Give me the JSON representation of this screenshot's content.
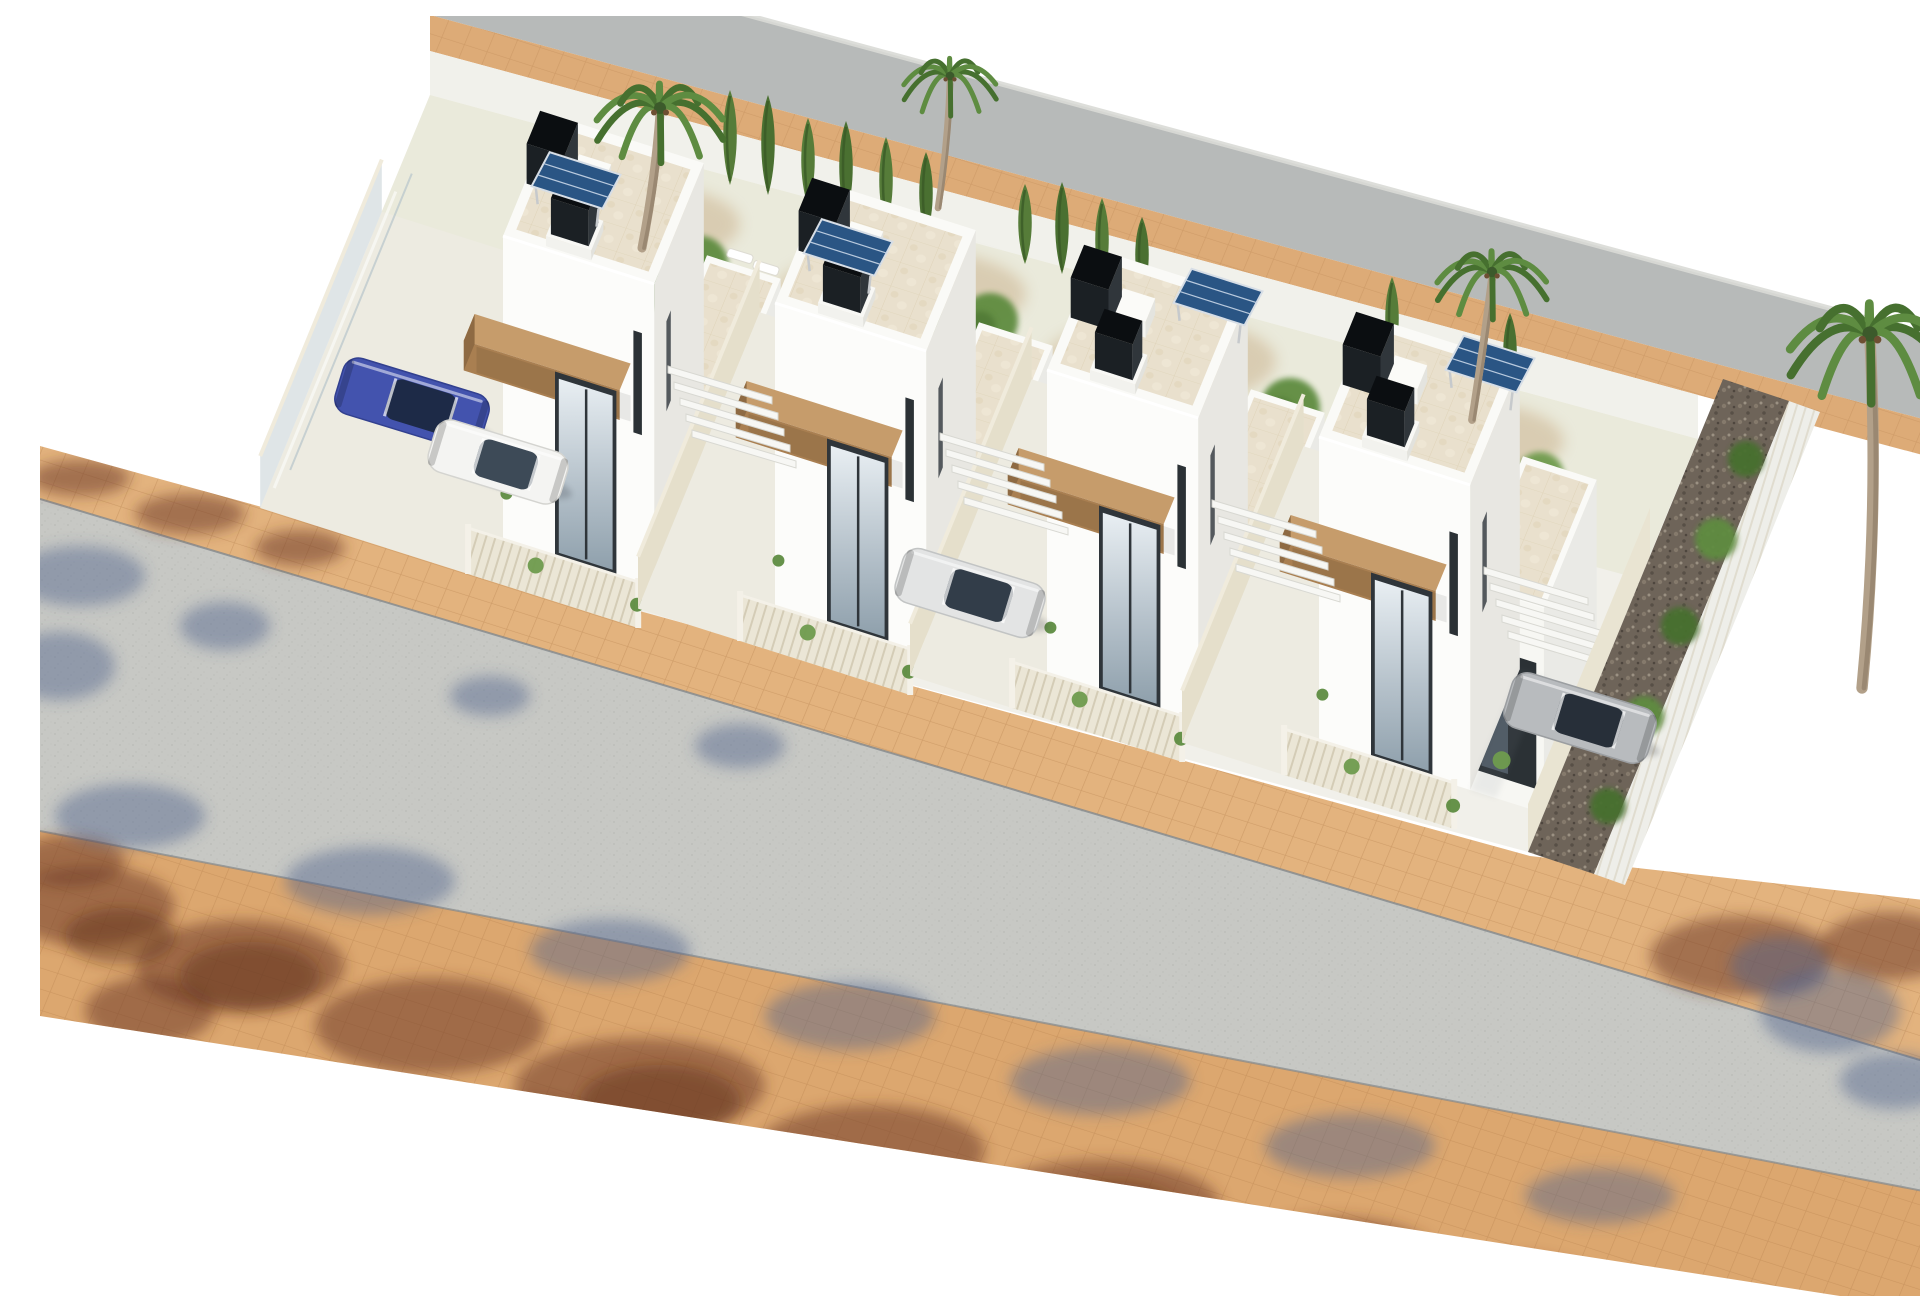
{
  "colors": {
    "bg": "#ffffff",
    "ground": "#f1f0ea",
    "patio": "#edebe1",
    "garden": "#eaeadb",
    "road_front": "#c7c8c4",
    "walk_tan": "#e3b37e",
    "walk_tan2": "#dca76f",
    "curb": "#82878b",
    "road_back": "#b7bab9",
    "back_tan": "#ddab77",
    "back_wall": "#f1f1eb",
    "far_fence": "#d9dad6",
    "tower_front": "#fcfcfa",
    "tower_side": "#e8e7e2",
    "low_front": "#f7f7f3",
    "low_side": "#eaeae6",
    "parapet": "#fafaf7",
    "deck_base": "#e9e0cd",
    "deck_line": "#dccfb4",
    "wood_top": "#c69c6b",
    "wood_front": "#a97f51",
    "wood_side": "#8e6a43",
    "fence_base": "#ebe6d6",
    "fence_slat": "#cdc5ad",
    "fence_top": "#f4f1e8",
    "beige_wall": "#e5dfcb",
    "beige_top": "#f0ebdc",
    "glass_wall": "#dfe5e7",
    "door_frame": "#2f353a",
    "win_dark": "#2b3135",
    "solar": "#2a5584",
    "solar_line": "#b9cade",
    "solar_frame": "#d7dee6",
    "solar_leg": "#c6c9cc",
    "box_front": "#1b2024",
    "box_side": "#30363b",
    "box_top": "#0b0e11",
    "ac_white": "#f4f4f0",
    "green_dark": "#46702f",
    "green_mid": "#5e8c41",
    "green_light": "#6f9b4e",
    "gravel_base": "#6e6459",
    "shadow_brown": "#6f3c27",
    "shadow_brown2": "#5a2d1c",
    "shadow_blue": "#4f618c",
    "trunk": "#b2a089",
    "trunk2": "#9a8872",
    "pool_rim": "#ffffff"
  },
  "projection": {
    "u": [
      0.945,
      0.3
    ],
    "v": [
      0.32,
      -0.78
    ]
  },
  "street": {
    "walk_top": [
      [
        0,
        430
      ],
      [
        1490,
        840
      ],
      [
        1920,
        888
      ]
    ],
    "road_top": [
      [
        0,
        483
      ],
      [
        1920,
        1056
      ]
    ],
    "road_bottom": [
      [
        0,
        815
      ],
      [
        1920,
        1182
      ]
    ],
    "walk_bottom": [
      [
        0,
        1000
      ],
      [
        1800,
        1280
      ]
    ]
  },
  "back_road": {
    "wall_band": [
      [
        390,
        79
      ],
      [
        1658,
        423
      ],
      [
        1658,
        379
      ],
      [
        390,
        35
      ]
    ],
    "tan": [
      [
        390,
        35
      ],
      [
        1658,
        379
      ],
      [
        1920,
        449
      ],
      [
        1920,
        413
      ],
      [
        1658,
        343
      ],
      [
        390,
        -1
      ]
    ],
    "road": [
      [
        390,
        -1
      ],
      [
        1658,
        343
      ],
      [
        1920,
        413
      ],
      [
        1920,
        327
      ],
      [
        1658,
        257
      ],
      [
        390,
        -87
      ]
    ],
    "far_fence": [
      [
        390,
        -87
      ],
      [
        1658,
        257
      ],
      [
        1920,
        327
      ]
    ]
  },
  "ground": [
    [
      220,
      492
    ],
    [
      1488,
      836
    ],
    [
      1658,
      423
    ],
    [
      390,
      79
    ]
  ],
  "garden": [
    [
      332,
      219
    ],
    [
      1600,
      563
    ],
    [
      1658,
      423
    ],
    [
      390,
      79
    ]
  ],
  "pebbles": [
    [
      600,
      208,
      100,
      40
    ],
    [
      860,
      278,
      126,
      46
    ],
    [
      1120,
      345,
      116,
      44
    ],
    [
      1420,
      425,
      104,
      40
    ]
  ],
  "bushes": [
    [
      540,
      196,
      24
    ],
    [
      660,
      248,
      28
    ],
    [
      800,
      246,
      22
    ],
    [
      950,
      305,
      28
    ],
    [
      1060,
      330,
      24
    ],
    [
      1250,
      392,
      30
    ],
    [
      1500,
      460,
      24
    ],
    [
      620,
      276,
      18
    ],
    [
      880,
      300,
      20
    ]
  ],
  "cypresses": [
    [
      690,
      169,
      95
    ],
    [
      728,
      179,
      100
    ],
    [
      768,
      190,
      88
    ],
    [
      806,
      200,
      95
    ],
    [
      846,
      211,
      90
    ],
    [
      886,
      221,
      85
    ],
    [
      985,
      248,
      80
    ],
    [
      1022,
      258,
      92
    ],
    [
      1062,
      268,
      86
    ],
    [
      1102,
      279,
      78
    ],
    [
      1352,
      346,
      85
    ],
    [
      1470,
      377,
      80
    ]
  ],
  "loungers": [
    [
      700,
      240
    ],
    [
      726,
      252
    ]
  ],
  "pool": [
    [
      1300,
      390
    ],
    [
      1338,
      401
    ],
    [
      1298,
      495
    ],
    [
      1260,
      484
    ]
  ],
  "villas": [
    {
      "origin": [
        463,
        525
      ],
      "solar": "L",
      "left_u": -240,
      "wall": "glass"
    },
    {
      "origin": [
        735,
        592
      ],
      "solar": "L",
      "left_u": -128,
      "wall": "beige"
    },
    {
      "origin": [
        1007,
        659
      ],
      "solar": "R",
      "left_u": -128,
      "wall": "beige"
    },
    {
      "origin": [
        1279,
        726
      ],
      "solar": "R",
      "left_u": -128,
      "wall": "beige"
    }
  ],
  "louvers": [
    [
      628,
      350
    ],
    [
      900,
      417
    ],
    [
      1172,
      484
    ],
    [
      1444,
      551
    ]
  ],
  "right_wall": [
    [
      1488,
      836
    ],
    [
      1610,
      540
    ],
    [
      1610,
      492
    ],
    [
      1488,
      788
    ]
  ],
  "gravel": [
    [
      1488,
      836
    ],
    [
      1610,
      540
    ],
    [
      1683,
      363
    ],
    [
      1749,
      385
    ],
    [
      1676,
      565
    ],
    [
      1554,
      858
    ]
  ],
  "right_fence": [
    [
      1554,
      858
    ],
    [
      1676,
      565
    ],
    [
      1749,
      385
    ],
    [
      1780,
      396
    ],
    [
      1707,
      576
    ],
    [
      1585,
      869
    ]
  ],
  "gravel_bushes": [
    [
      1568,
      790,
      18
    ],
    [
      1604,
      700,
      20
    ],
    [
      1640,
      610,
      19
    ],
    [
      1676,
      523,
      21
    ],
    [
      1706,
      443,
      18
    ]
  ],
  "cars": [
    {
      "c": [
        372,
        388
      ],
      "angle": 17,
      "len": 152,
      "w": 58,
      "color": "blue",
      "name": "blue-car"
    },
    {
      "c": [
        458,
        446
      ],
      "angle": 17,
      "len": 138,
      "w": 54,
      "color": "white",
      "name": "white-car"
    },
    {
      "c": [
        930,
        577
      ],
      "angle": 17,
      "len": 148,
      "w": 56,
      "color": "silver",
      "name": "silver-car"
    },
    {
      "c": [
        1540,
        702
      ],
      "angle": 17,
      "len": 150,
      "w": 57,
      "color": "gray",
      "name": "gray-car"
    }
  ],
  "car_colors": {
    "blue": {
      "body": "#4353ae",
      "glass": "#1d2a47",
      "edge": "#32408f"
    },
    "white": {
      "body": "#f4f4f2",
      "glass": "#3d4a57",
      "edge": "#d4d4d0"
    },
    "silver": {
      "body": "#e3e4e4",
      "glass": "#323d49",
      "edge": "#c2c4c4"
    },
    "gray": {
      "body": "#b8bbbe",
      "glass": "#272f39",
      "edge": "#9b9ea1"
    }
  },
  "palms": [
    {
      "c": [
        620,
        92
      ],
      "base": [
        602,
        232
      ],
      "s": 1.5
    },
    {
      "c": [
        910,
        60
      ],
      "base": [
        898,
        192
      ],
      "s": 1.1
    },
    {
      "c": [
        1452,
        256
      ],
      "base": [
        1432,
        404
      ],
      "s": 1.3
    },
    {
      "c": [
        1830,
        318
      ],
      "base": [
        1822,
        672
      ],
      "s": 1.9
    }
  ],
  "shadows": {
    "brown": [
      [
        40,
        462,
        50,
        18
      ],
      [
        150,
        498,
        55,
        20
      ],
      [
        260,
        532,
        45,
        18
      ],
      [
        30,
        845,
        55,
        26
      ],
      [
        50,
        890,
        85,
        40
      ],
      [
        200,
        950,
        105,
        46
      ],
      [
        390,
        1010,
        115,
        48
      ],
      [
        600,
        1070,
        125,
        48
      ],
      [
        830,
        1135,
        115,
        46
      ],
      [
        1060,
        1190,
        120,
        46
      ],
      [
        1290,
        1245,
        110,
        44
      ],
      [
        1470,
        1280,
        95,
        40
      ],
      [
        110,
        995,
        65,
        34
      ],
      [
        490,
        1120,
        75,
        38
      ],
      [
        920,
        1225,
        70,
        36
      ],
      [
        1180,
        1275,
        80,
        36
      ],
      [
        1700,
        940,
        90,
        40
      ],
      [
        1850,
        930,
        70,
        34
      ]
    ],
    "brown2": [
      [
        210,
        960,
        70,
        34
      ],
      [
        620,
        1085,
        80,
        36
      ],
      [
        1070,
        1200,
        75,
        34
      ],
      [
        1420,
        1272,
        70,
        30
      ],
      [
        80,
        920,
        55,
        28
      ]
    ],
    "blue": [
      [
        40,
        560,
        65,
        30
      ],
      [
        20,
        650,
        55,
        34
      ],
      [
        185,
        610,
        45,
        24
      ],
      [
        450,
        680,
        40,
        20
      ],
      [
        90,
        800,
        75,
        32
      ],
      [
        330,
        865,
        85,
        34
      ],
      [
        570,
        935,
        80,
        32
      ],
      [
        810,
        1000,
        85,
        34
      ],
      [
        1060,
        1065,
        90,
        34
      ],
      [
        1310,
        1130,
        85,
        32
      ],
      [
        1560,
        1180,
        75,
        28
      ],
      [
        1790,
        995,
        70,
        42
      ],
      [
        1855,
        1065,
        55,
        28
      ],
      [
        1740,
        950,
        50,
        30
      ],
      [
        700,
        730,
        45,
        22
      ]
    ]
  }
}
